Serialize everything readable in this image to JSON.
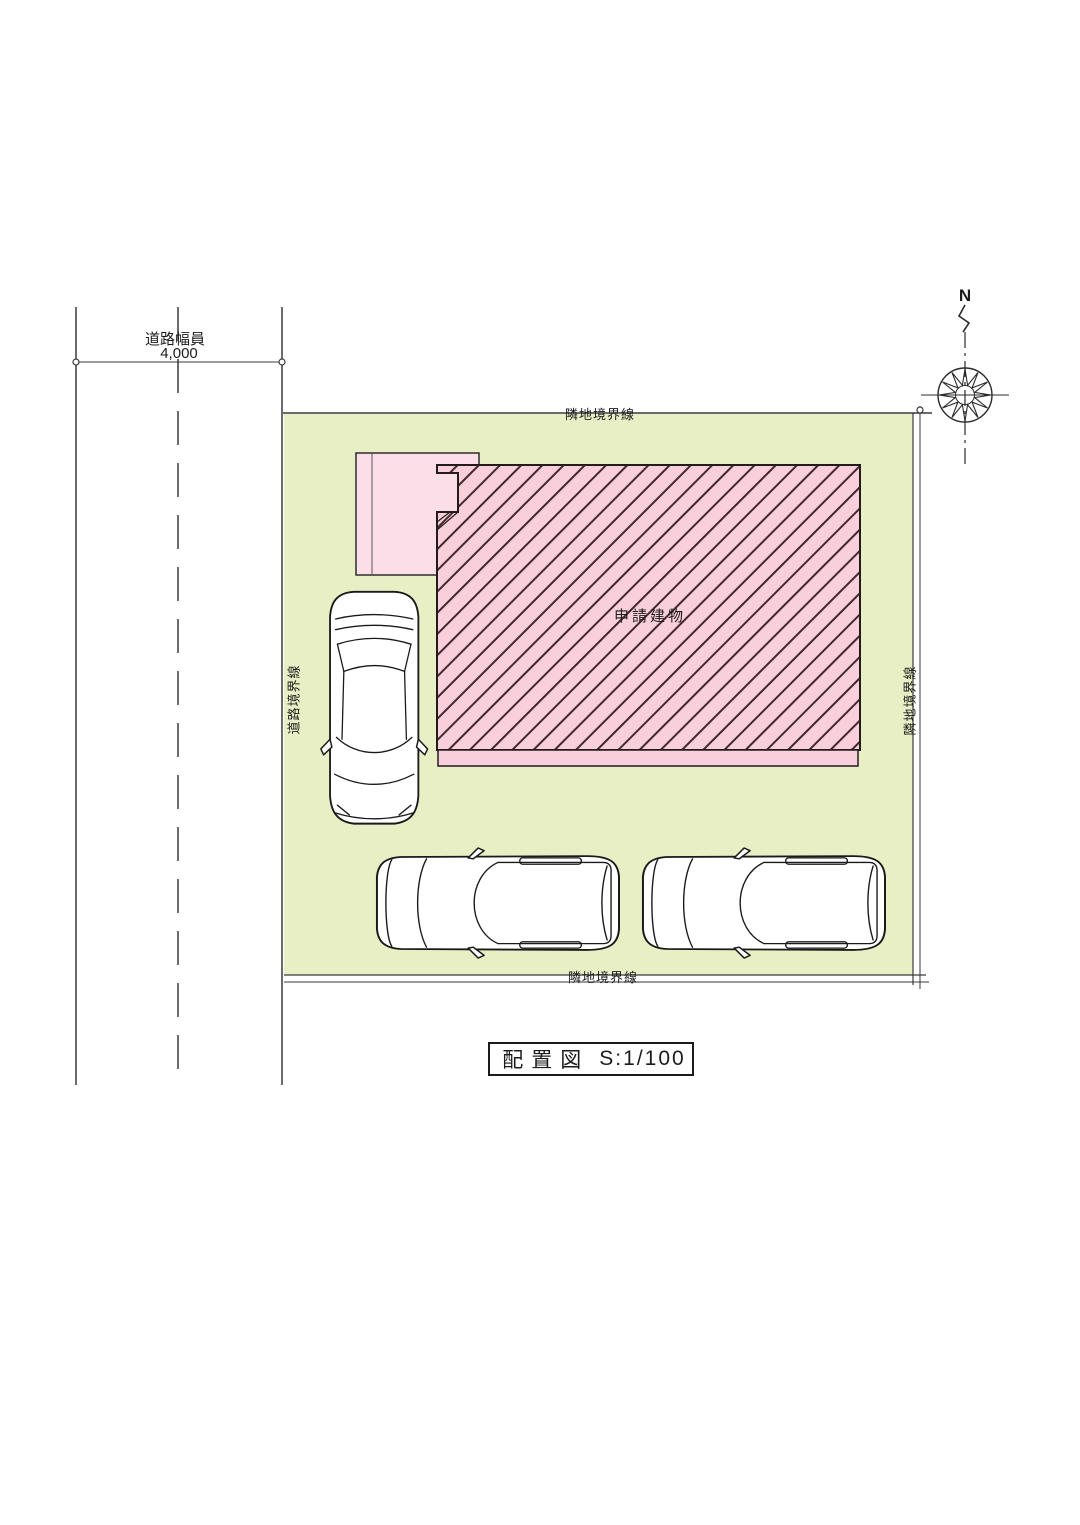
{
  "colors": {
    "site_green": "#e9efc4",
    "building_pink": "#f8cfda",
    "porch_pink": "#fcdee8",
    "hatch_line": "#43282f",
    "line_dark": "#3a3a3a"
  },
  "road": {
    "width_label": "道路幅員",
    "width_value": "4,000"
  },
  "site": {
    "boundary_top": "隣地境界線",
    "boundary_bottom": "隣地境界線",
    "boundary_right": "隣地境界線",
    "boundary_left": "道路境界線"
  },
  "building": {
    "label": "申請建物"
  },
  "compass": {
    "north_label": "N"
  },
  "title_block": {
    "name": "配置図",
    "scale": "S:1/100"
  }
}
